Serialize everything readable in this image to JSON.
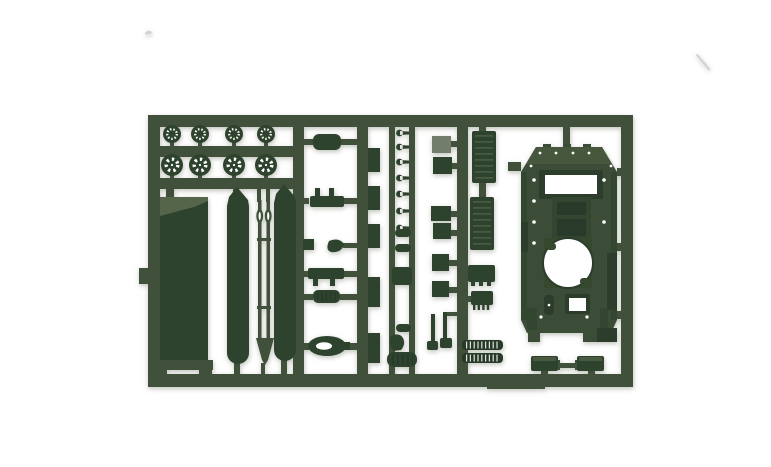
{
  "photo": {
    "subject": "Injection-molded plastic model kit sprue in dark military green with tank parts",
    "background": "plain white studio backdrop",
    "orientation": "landscape"
  },
  "colors": {
    "background": "#ffffff",
    "runner": "#41503b",
    "part": "#2e432e",
    "part_dark": "#273a28",
    "part_light": "#55654a",
    "part_gray": "#727d6b",
    "rib_light": "#4a5a41",
    "hull": "#3b4d37",
    "hull_top": "#46573d",
    "hull_panel": "#334630",
    "hull_recess": "#283a29",
    "hull_dark": "#2c3e2b",
    "hull_ring_area": "#36492f",
    "hole": "#ffffff",
    "artifact": "#d2d2d2"
  },
  "parts_inventory": {
    "small_road_wheels": 4,
    "large_road_wheels": 4,
    "hull_floor_plate": 1,
    "side_skirts": 2,
    "gun_barrel_rods": 2,
    "upper_hull_shell": 1,
    "hatch_and_box_parts": 10,
    "radiator_grilles": 2,
    "track_end_sections": 2,
    "tow_shackle": 1,
    "muffler": 1
  }
}
